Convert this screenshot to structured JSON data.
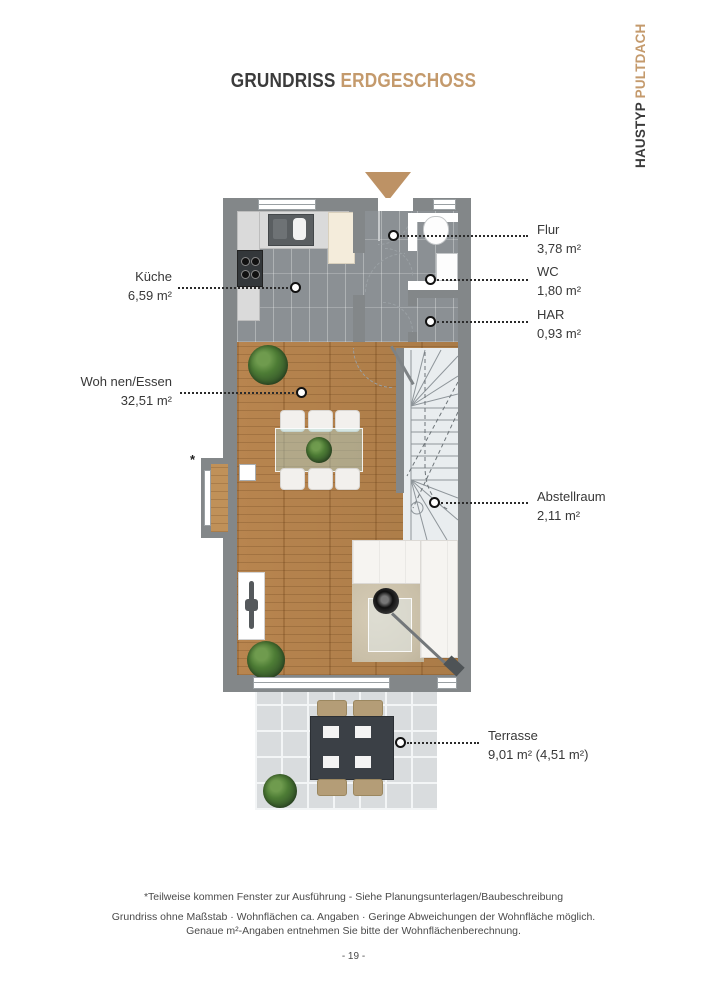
{
  "header": {
    "title_primary": "GRUNDRISS",
    "title_accent": "ERDGESCHOSS"
  },
  "side_banner": {
    "primary": "HAUSTYP",
    "accent": "PULTDACH"
  },
  "plan": {
    "window_note": "*",
    "rooms": [
      {
        "id": "kueche",
        "name": "Küche",
        "area": "6,59 m²",
        "side": "left"
      },
      {
        "id": "wohnen",
        "name": "Woh nen/Essen",
        "area": "32,51 m²",
        "side": "left"
      },
      {
        "id": "flur",
        "name": "Flur",
        "area": "3,78 m²",
        "side": "right"
      },
      {
        "id": "wc",
        "name": "WC",
        "area": "1,80 m²",
        "side": "right"
      },
      {
        "id": "har",
        "name": "HAR",
        "area": "0,93 m²",
        "side": "right"
      },
      {
        "id": "abstellraum",
        "name": "Abstellraum",
        "area": "2,11 m²",
        "side": "right"
      },
      {
        "id": "terrasse",
        "name": "Terrasse",
        "area": "9,01 m² (4,51 m²)",
        "side": "right"
      }
    ]
  },
  "footer": {
    "footnote": "*Teilweise kommen Fenster zur Ausführung - Siehe Planungsunterlagen/Baubeschreibung",
    "disclaimer_line1": "Grundriss ohne Maßstab · Wohnflächen ca. Angaben · Geringe Abweichungen der Wohnfläche möglich.",
    "disclaimer_line2": "Genaue m²-Angaben entnehmen Sie bitte der Wohnflächenberechnung.",
    "page_number": "- 19 -"
  },
  "colors": {
    "accent": "#c49a6c",
    "wall_gray": "#838789",
    "wood": "#b2814e",
    "text": "#3a3a3a"
  }
}
